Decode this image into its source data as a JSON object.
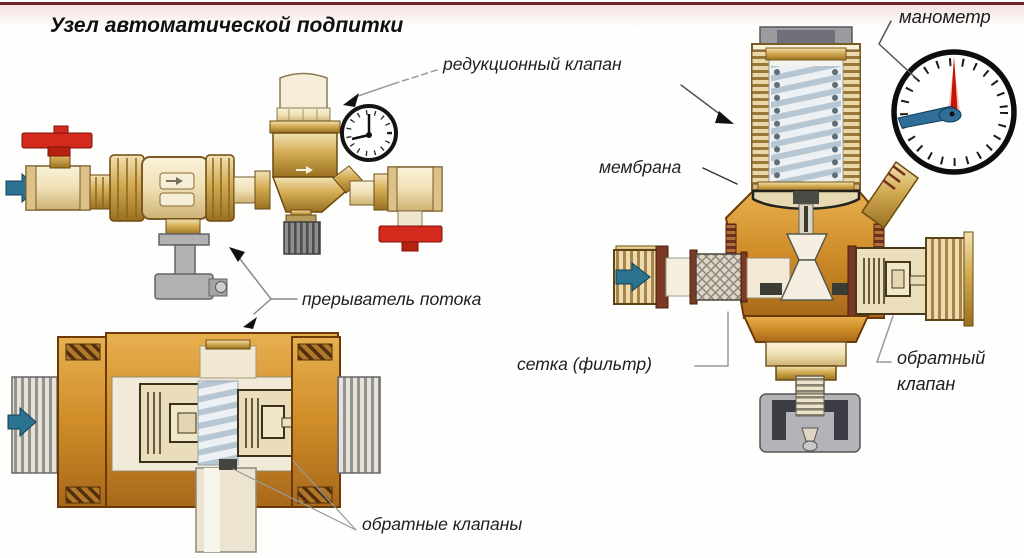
{
  "page": {
    "title": "Узел автоматической подпитки"
  },
  "labels": {
    "reduction_valve": "редукционный клапан",
    "manometer": "манометр",
    "membrane": "мембрана",
    "flow_interrupter": "прерыватель потока",
    "mesh_filter": "сетка (фильтр)",
    "check_valve": "обратный клапан",
    "check_valves": "обратные клапаны"
  },
  "colors": {
    "top_border": "#6e2626",
    "brass": "#d3ab52",
    "brass_light": "#efe0b4",
    "brass_dark": "#8a5c12",
    "body_orange": "#cf8c28",
    "red_handle": "#d42a1e",
    "flow_arrow_blue": "#2a7391",
    "gray_metal": "#b0b0b0",
    "spring_blue": "#b6c6d2",
    "gauge_needle_red": "#c81203",
    "gauge_needle_blue": "#2e6e99",
    "label_text": "#1e1e1e"
  }
}
